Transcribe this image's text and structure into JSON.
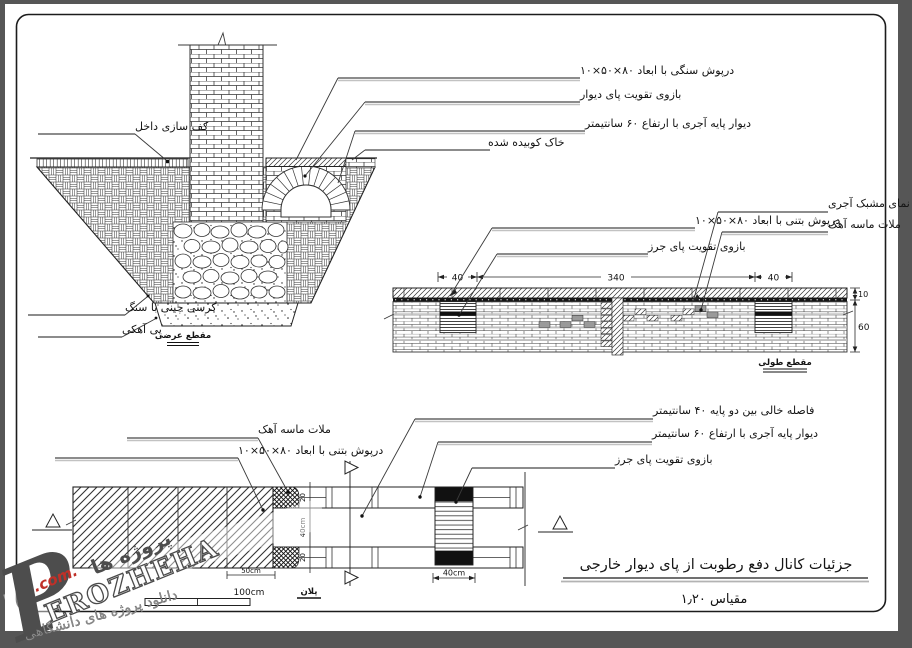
{
  "cross_section": {
    "caption": "مقطع عرضی",
    "label_stone_cap": "درپوش سنگی با ابعاد ۸۰×۵۰×۱۰",
    "label_arm": "بازوی تقویت پای دیوار",
    "label_base_wall": "دیوار پایه آجری با ارتفاع ۶۰ سانتیمتر",
    "label_compacted_soil": "خاک کوبیده شده",
    "label_interior_floor": "کف سازی داخل",
    "label_stone_course": "کرسی چینی با سنگ",
    "label_lime_foundation": "پی آهکی"
  },
  "long_section": {
    "caption": "مقطع طولی",
    "label_brick_lattice": "نمای مشبک آجری",
    "label_lime_mortar": "ملات ماسه آهک",
    "label_concrete_cap": "درپوش بتنی با ابعاد ۸۰×۵۰×۱۰",
    "label_pier_arm": "بازوی تقویت پای جرز",
    "dim_left": "40",
    "dim_middle": "340",
    "dim_right": "40",
    "dim_cap_h": "10",
    "dim_wall_h": "60"
  },
  "plan": {
    "caption": "پلان",
    "label_lime_mortar": "ملات ماسه آهک",
    "label_concrete_cap": "درپوش بتنی با ابعاد ۸۰×۵۰×۱۰",
    "label_gap": "فاصله خالی بین دو پایه ۴۰ سانتیمتر",
    "label_base_wall": "دیوار پایه آجری با ارتفاع ۶۰ سانتیمتر",
    "label_pier_arm": "بازوی تقویت پای جرز",
    "dim_row_top": "20",
    "dim_gap": "40cm",
    "dim_row_bottom": "20",
    "dim_cap_segment": "50cm",
    "dim_pier": "40cm",
    "scale_bar_label": "100cm"
  },
  "title_block": {
    "title": "جزئیات کانال دفع رطوبت از پای دیوار خارجی",
    "scale": "مقیاس ۱٫۲۰"
  },
  "watermark": {
    "initial": "P",
    "brand": "EROZHEHA",
    "suffix": ".com.",
    "brand_fa": "پروژه ها",
    "tagline": "دانلود پروژه های دانشگاهی"
  }
}
